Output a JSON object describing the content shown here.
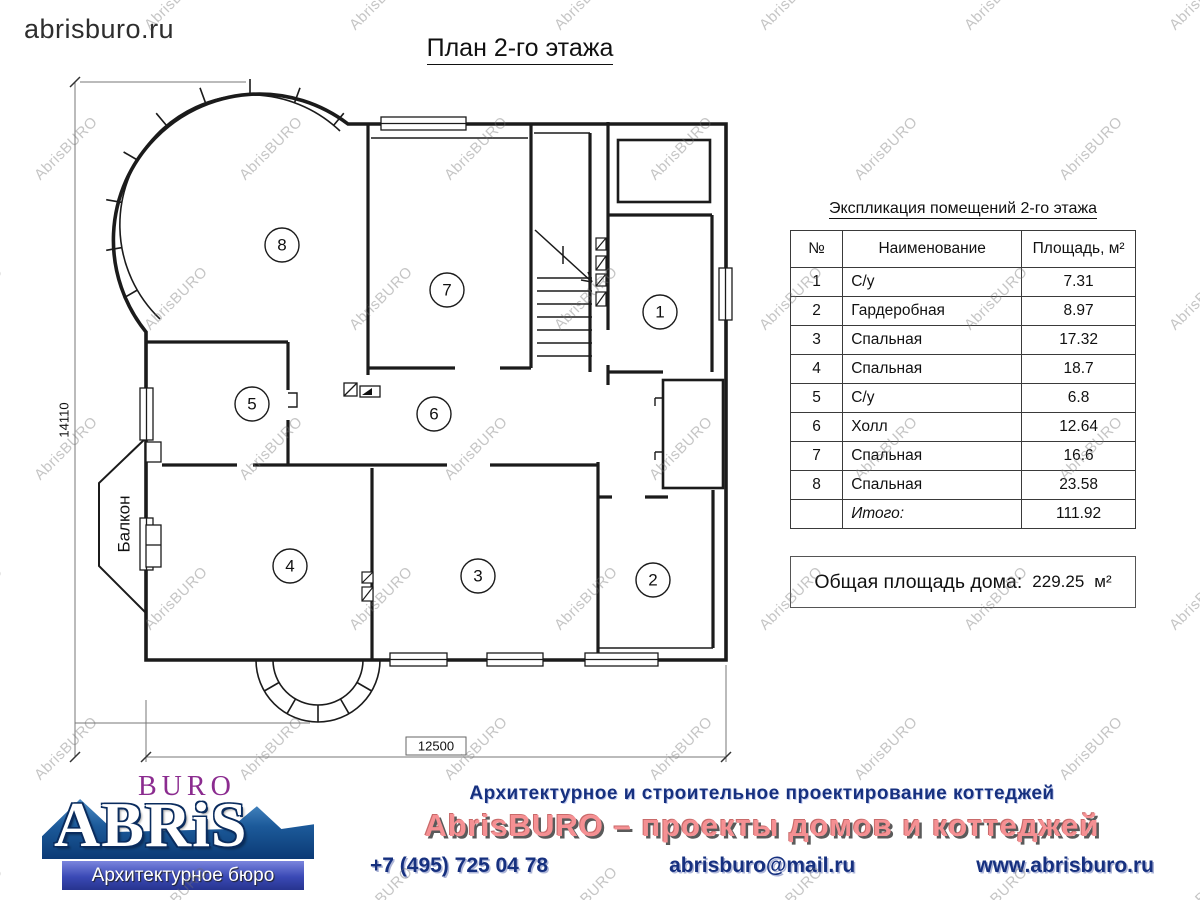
{
  "page": {
    "site": "abrisburo.ru",
    "title": "План 2-го этажа"
  },
  "plan": {
    "dim_height": "14110",
    "dim_width": "12500",
    "balcony_label": "Балкон",
    "room_numbers": [
      "8",
      "7",
      "1",
      "5",
      "6",
      "4",
      "3",
      "2"
    ]
  },
  "expl_table": {
    "title": "Экспликация помещений 2-го этажа",
    "columns": [
      "№",
      "Наименование",
      "Площадь, м²"
    ],
    "rows": [
      [
        "1",
        "С/у",
        "7.31"
      ],
      [
        "2",
        "Гардеробная",
        "8.97"
      ],
      [
        "3",
        "Спальная",
        "17.32"
      ],
      [
        "4",
        "Спальная",
        "18.7"
      ],
      [
        "5",
        "С/у",
        "6.8"
      ],
      [
        "6",
        "Холл",
        "12.64"
      ],
      [
        "7",
        "Спальная",
        "16.6"
      ],
      [
        "8",
        "Спальная",
        "23.58"
      ]
    ],
    "total_label": "Итого:",
    "total_value": "111.92"
  },
  "total_area": {
    "label": "Общая площадь дома:",
    "value": "229.25",
    "unit": "м²"
  },
  "footer": {
    "logo": {
      "buro": "BURO",
      "abris": "ABRiS",
      "tagline": "Архитектурное бюро"
    },
    "line1": "Архитектурное и строительное проектирование коттеджей",
    "line2": "AbrisBURO – проекты домов и коттеджей",
    "phone": "+7 (495) 725 04 78",
    "email": "abrisburo@mail.ru",
    "site": "www.abrisburo.ru"
  },
  "watermark": {
    "text": "AbrisBURO"
  },
  "colors": {
    "wall": "#1b1b1b",
    "dim": "#666666",
    "navy": "#16307f",
    "pink": "#f59093",
    "purple": "#8b2b8f"
  }
}
